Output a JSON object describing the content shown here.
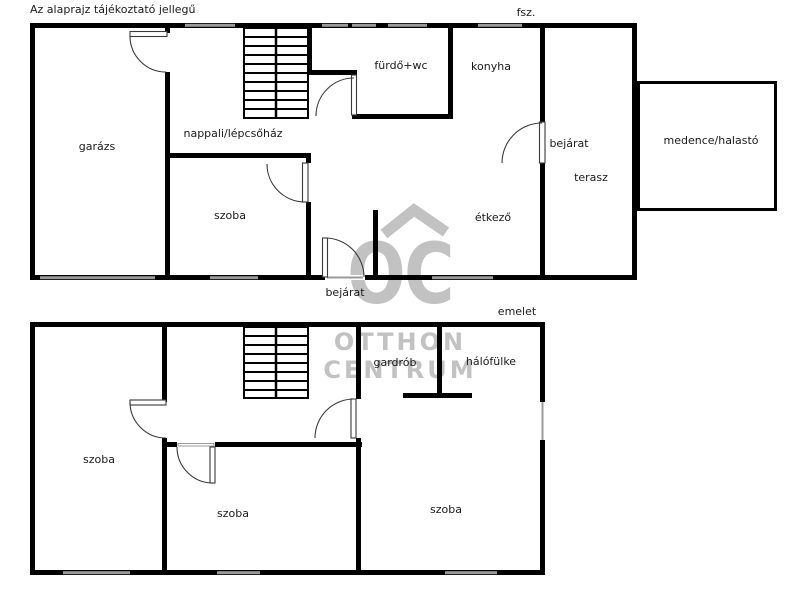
{
  "disclaimer": "Az alaprajz tájékoztató jellegű",
  "ground_floor": {
    "floor_label": "fsz.",
    "rooms": {
      "garage": "garázs",
      "living_staircase": "nappali/lépcsőház",
      "room": "szoba",
      "bathroom_wc": "fürdő+wc",
      "kitchen": "konyha",
      "entrance_side": "bejárat",
      "terrace": "terasz",
      "dining": "étkező",
      "pool_fishpond": "medence/halastó",
      "entrance_front": "bejárat"
    }
  },
  "upper_floor": {
    "floor_label": "emelet",
    "rooms": {
      "wardrobe": "gardrób",
      "sleeping_alcove": "hálófülke",
      "room_left": "szoba",
      "room_middle": "szoba",
      "room_right": "szoba"
    }
  },
  "watermark": {
    "initials": "OC",
    "line1": "OTTHON",
    "line2": "CENTRUM"
  },
  "colors": {
    "walls": "#000000",
    "windows": "#9a9a9a",
    "door_lines": "#3a3a3a",
    "watermark": "#c2c2c2",
    "background": "#ffffff",
    "text": "#1a1a1a"
  }
}
